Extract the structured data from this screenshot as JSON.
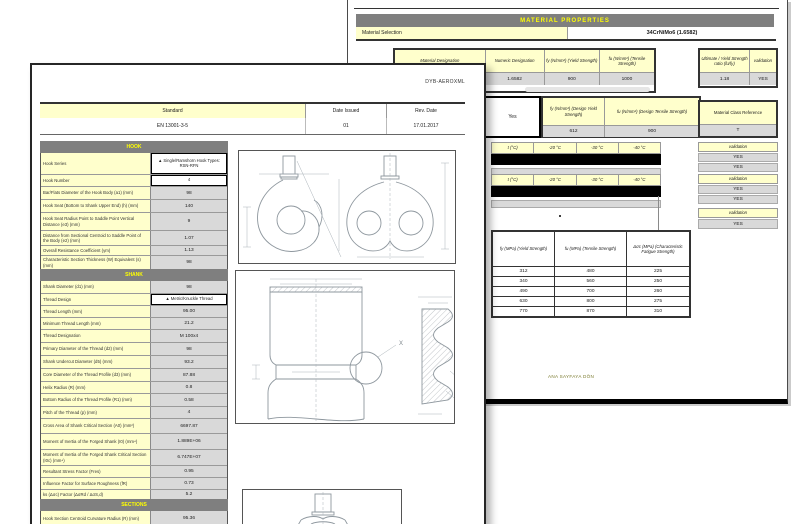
{
  "front_page": {
    "doc_code": "DYB-AEROXML",
    "header": {
      "standard_label": "Standard",
      "standard_value": "EN 13001-3-5",
      "date_issued_label": "Date Issued",
      "date_issued_value": "01",
      "rev_date_label": "Rev. Date",
      "rev_date_value": "17.01.2017"
    },
    "section_titles": {
      "hook": "HOOK",
      "shank": "SHANK",
      "sections": "SECTIONS"
    },
    "hook_rows": [
      {
        "label": "Hook Series",
        "value": "▲ Single/Ramshorn Hook Types: RSN-RFN"
      },
      {
        "label": "Hook Number",
        "value": "4"
      },
      {
        "label": "Bar/Flats Diameter of the Hook Body (a1) (mm)",
        "value": "98"
      },
      {
        "label": "Hook Seat (Bottom to Shank Upper End) (h) (mm)",
        "value": "140"
      },
      {
        "label": "Hook Seat Radius Point to Saddle Point Vertical Distance (e3) (mm)",
        "value": "9"
      },
      {
        "label": "Distance from Sectional Centroid to Saddle Point of the Body (e2) (mm)",
        "value": "1.07"
      },
      {
        "label": "Overall Resistance Coefficient (γm)",
        "value": "1.13"
      },
      {
        "label": "Characteristic Section Thickness (W) Equivalent (s) (mm)",
        "value": "98"
      }
    ],
    "shank_rows": [
      {
        "label": "Shank Diameter (d1) (mm)",
        "value": "98"
      },
      {
        "label": "Thread Design",
        "value": "▲ Metric/Knuckle Thread"
      },
      {
        "label": "Thread Length (mm)",
        "value": "95.00"
      },
      {
        "label": "Minimum Thread Length (mm)",
        "value": "21.2"
      },
      {
        "label": "Thread Designation",
        "value": "M 100x4"
      },
      {
        "label": "Primary Diameter of the Thread (d2) (mm)",
        "value": "98"
      },
      {
        "label": "Shank Undercut Diameter (d5) (mm)",
        "value": "93.2"
      },
      {
        "label": "Core Diameter of the Thread Profile (d3) (mm)",
        "value": "87.88"
      },
      {
        "label": "Helix Radius (R) (mm)",
        "value": "0.8"
      },
      {
        "label": "Bottom Radius of the Thread Profile (R1) (mm)",
        "value": "0.58"
      },
      {
        "label": "Pitch of the Thread (p) (mm)",
        "value": "4"
      },
      {
        "label": "Cross Area of Shank Critical Section (A0) (mm²)",
        "value": "6697.87"
      },
      {
        "label": "Moment of Inertia of the Forged Shank (I0) (mm⁴)",
        "value": "1.889E+06"
      },
      {
        "label": "Moment of Inertia of the Forged Shank Critical Section (I0c) (mm⁴)",
        "value": "6.747E+07"
      },
      {
        "label": "Resultant Stress Factor (Fres)",
        "value": "0.95"
      },
      {
        "label": "Influence Factor for Surface Roughness (fR)",
        "value": "0.73"
      },
      {
        "label": "ks (Δσc) Factor (ΔσRd / ΔσS,d)",
        "value": "5.2"
      }
    ],
    "sections_rows": [
      {
        "label": "Hook Section Centroid Curvature Radius (R) (mm)",
        "value": "95.36"
      }
    ]
  },
  "back_page": {
    "title": "MATERIAL PROPERTIES",
    "material_selection": {
      "label": "Material Selection",
      "value": "34CrNiMo6 (1.6582)"
    },
    "table1": {
      "headers": [
        "Material Designation",
        "Numeric Designation",
        "fy (N/mm²) (Yield Strength)",
        "fu (N/mm²) (Tensile Strength)"
      ],
      "values": [
        "34CrNiMo6",
        "1.6582",
        "900",
        "1000"
      ]
    },
    "ratio_box": {
      "headers": [
        "Ultimate / Yield Strength ratio (fu/fy)",
        "validation"
      ],
      "values": [
        "1.18",
        "YES"
      ]
    },
    "yes_box": "Yes",
    "design_table": {
      "headers": [
        "fy (N/mm²) (Design Yield Strength)",
        "fu (N/mm²) (Design Tensile Strength)"
      ],
      "values": [
        "612",
        "900"
      ]
    },
    "class_box": {
      "label": "Material Class Reference",
      "value": "T"
    },
    "temp_table1": {
      "headers": [
        "t (°C)",
        "-20 °C",
        "-30 °C",
        "-40 °C"
      ]
    },
    "temp_table2": {
      "headers": [
        "t (°C)",
        "-20 °C",
        "-30 °C",
        "-40 °C"
      ]
    },
    "validation1": {
      "label": "validation",
      "values": [
        "YES",
        "YES"
      ]
    },
    "validation2": {
      "label": "validation",
      "values": [
        "YES",
        "YES"
      ]
    },
    "validation3": {
      "label": "validation",
      "values": [
        "YES"
      ]
    },
    "fatigue_table": {
      "headers": [
        "fy (MPa) (Yield Strength)",
        "fu (MPa) (Tensile Strength)",
        "Δσc (MPa) (Characteristic Fatigue Strength)"
      ],
      "rows": [
        [
          "312",
          "480",
          "225"
        ],
        [
          "340",
          "560",
          "250"
        ],
        [
          "490",
          "700",
          "260"
        ],
        [
          "630",
          "800",
          "275"
        ],
        [
          "770",
          "870",
          "310"
        ]
      ]
    },
    "footer_link": "ANA SAYFAYA DÖN"
  },
  "drawings": {
    "detail_label": "X"
  },
  "colors": {
    "label_yellow": "#ffffcc",
    "value_gray": "#d9d9d9",
    "band_gray": "#7f7f7f",
    "band_text_yellow": "#ffff00",
    "highlight_black": "#000000"
  }
}
